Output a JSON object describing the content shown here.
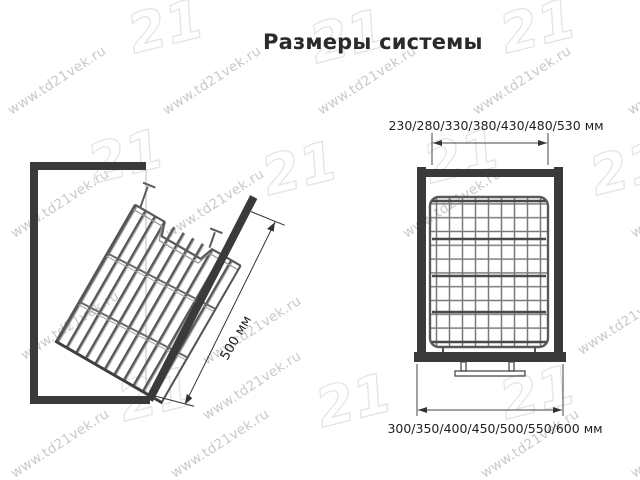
{
  "title": "Размеры системы",
  "watermark": {
    "url": "www.td21vek.ru",
    "logo": "21"
  },
  "side_view": {
    "depth_dimension": "500 мм"
  },
  "front_view": {
    "width_dimension_top": "230/280/330/380/430/480/530 мм",
    "width_dimension_bottom": "300/350/400/450/500/550/600 мм"
  }
}
